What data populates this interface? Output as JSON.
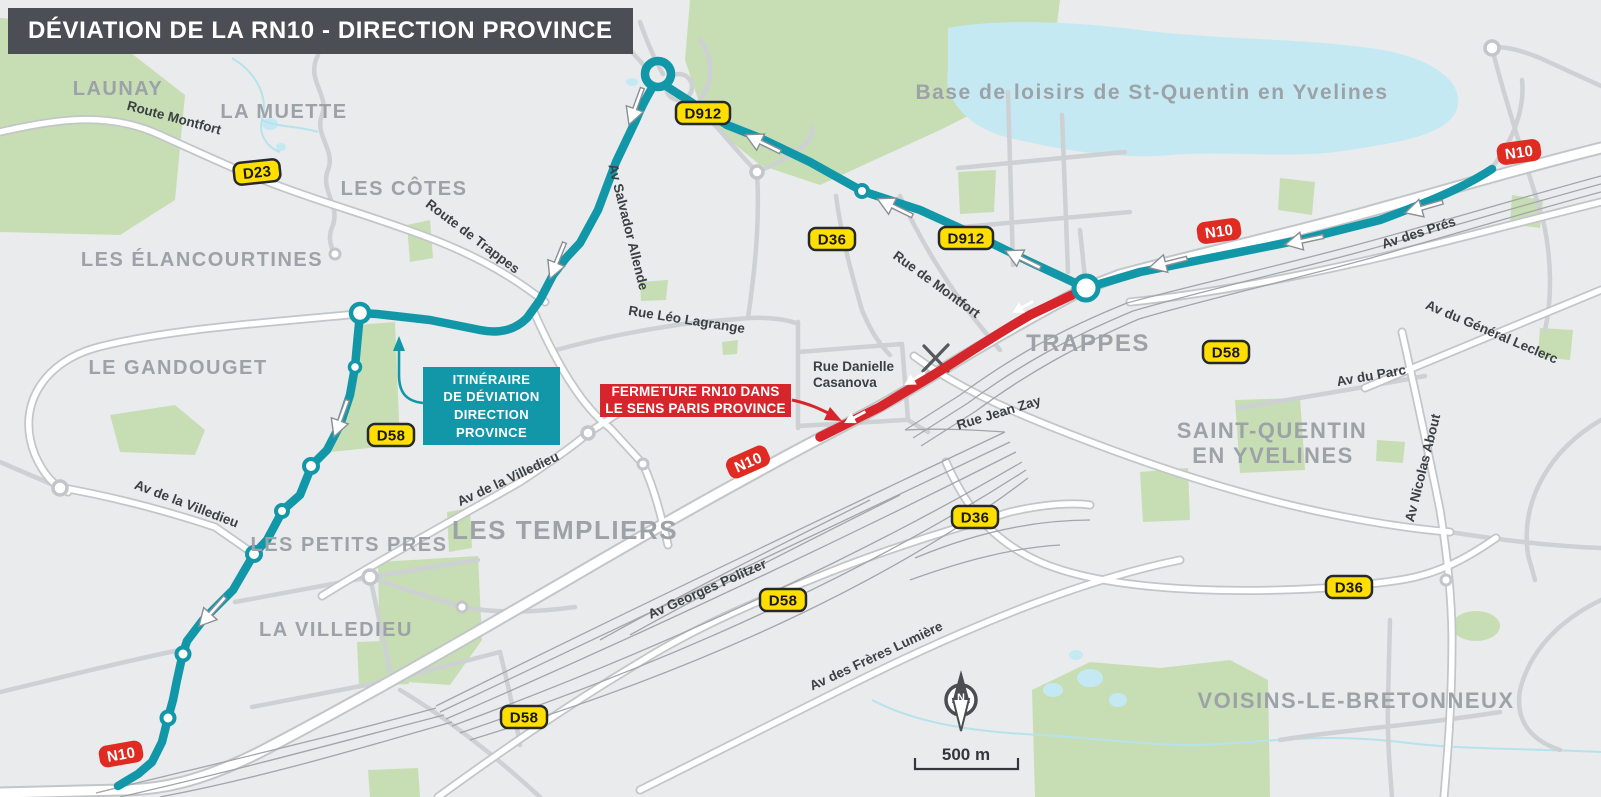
{
  "title": "DÉVIATION DE LA RN10 - DIRECTION PROVINCE",
  "colors": {
    "title_bar": "#4B4F55",
    "deviation_teal": "#1297A9",
    "closure_red": "#D6262C",
    "badge_yellow": "#FFDE00",
    "badge_red_n10": "#DF2B22",
    "map_background": "#E9EBEC"
  },
  "callouts": {
    "deviation": {
      "line1": "ITINÉRAIRE",
      "line2": "DE DÉVIATION",
      "line3": "DIRECTION",
      "line4": "PROVINCE"
    },
    "closure": {
      "line1": "FERMETURE RN10 DANS",
      "line2": "LE SENS PARIS PROVINCE"
    }
  },
  "districts": [
    {
      "label": "LAUNAY"
    },
    {
      "label": "LA MUETTE"
    },
    {
      "label": "LES CÔTES"
    },
    {
      "label": "LES ÉLANCOURTINES"
    },
    {
      "label": "LE GANDOUGET"
    },
    {
      "label": "LES PETITS PRES"
    },
    {
      "label": "LA VILLEDIEU"
    },
    {
      "label": "LES TEMPLIERS"
    },
    {
      "label": "TRAPPES"
    },
    {
      "label": "SAINT-QUENTIN"
    },
    {
      "label": "EN YVELINES"
    },
    {
      "label": "VOISINS-LE-BRETONNEUX"
    },
    {
      "label": "Base de loisirs de St-Quentin en Yvelines"
    }
  ],
  "streets": [
    {
      "label": "Route Montfort"
    },
    {
      "label": "Route de Trappes"
    },
    {
      "label": "Av Salvador Allende"
    },
    {
      "label": "Rue Léo Lagrange"
    },
    {
      "label": "Rue de Montfort"
    },
    {
      "label": "Rue Danielle"
    },
    {
      "label": "Casanova"
    },
    {
      "label": "Rue Jean Zay"
    },
    {
      "label": "Av des Prés"
    },
    {
      "label": "Av du Général Leclerc"
    },
    {
      "label": "Av du Parc"
    },
    {
      "label": "Av Nicolas About"
    },
    {
      "label": "Av de la Villedieu"
    },
    {
      "label": "Av de la Villedieu"
    },
    {
      "label": "Av Georges Politzer"
    },
    {
      "label": "Av des Frères Lumière"
    }
  ],
  "badges": [
    {
      "label": "D23"
    },
    {
      "label": "D912"
    },
    {
      "label": "D912"
    },
    {
      "label": "D36"
    },
    {
      "label": "D36"
    },
    {
      "label": "D36"
    },
    {
      "label": "D58"
    },
    {
      "label": "D58"
    },
    {
      "label": "D58"
    },
    {
      "label": "D58"
    },
    {
      "label": "N10"
    },
    {
      "label": "N10"
    },
    {
      "label": "N10"
    },
    {
      "label": "N10"
    }
  ],
  "map": {
    "scale_label": "500 m",
    "compass_label": "N"
  }
}
